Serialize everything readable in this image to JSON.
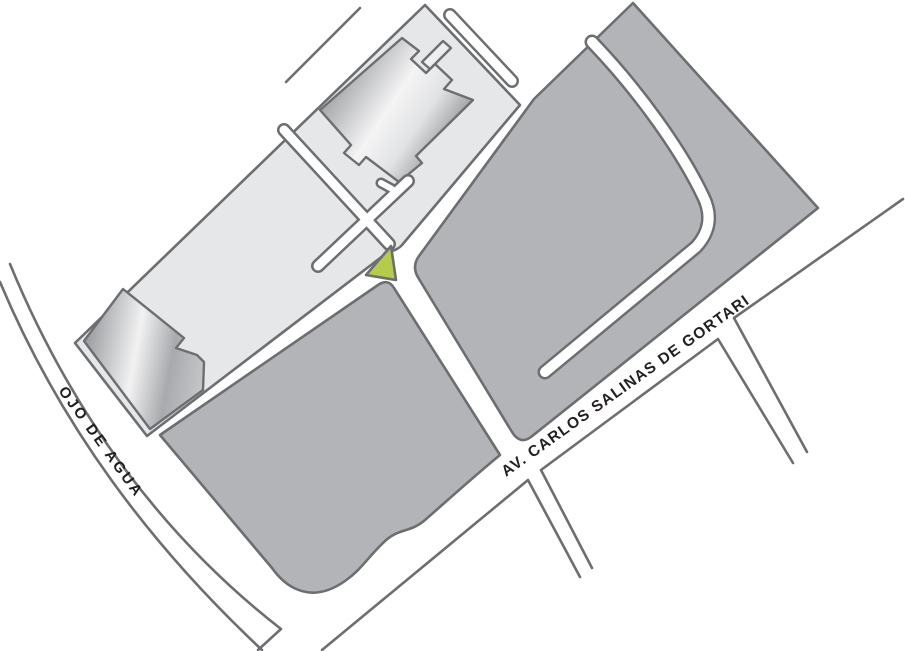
{
  "map": {
    "streets": {
      "ojo_de_agua": "OJO DE AGUA",
      "av_carlos_salinas": "AV. CARLOS SALINAS DE GORTARI"
    },
    "colors": {
      "background": "#ffffff",
      "outline": "#6d6e71",
      "block_light": "#e6e7e8",
      "block_dark": "#b2b4b7",
      "road_white": "#ffffff",
      "parcel_green": "#b5cb4c",
      "label_text": "#231f20"
    },
    "landmarks": {
      "highlighted_parcel": "green-triangle-parcel",
      "building_count": "2"
    }
  }
}
